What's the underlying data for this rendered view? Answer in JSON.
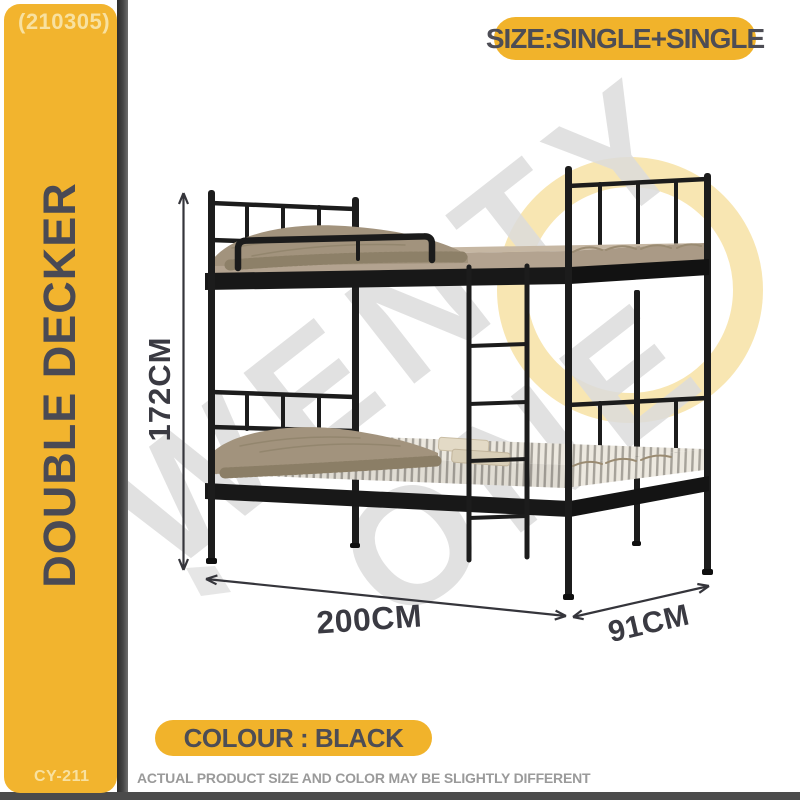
{
  "page": {
    "background": "#ffffff",
    "frame_bar_color": "#4b4b4b"
  },
  "sidebar": {
    "background": "#f2b42e",
    "batch_code": "(210305)",
    "title": "DOUBLE DECKER",
    "model": "CY-211",
    "title_color": "#4a4a54",
    "code_color": "#f8e1a0"
  },
  "badges": {
    "size": {
      "label": "SIZE:SINGLE+SINGLE",
      "background": "#f1b32b",
      "text_color": "#4d4d55"
    },
    "colour": {
      "label": "COLOUR : BLACK",
      "background": "#f1b32b",
      "text_color": "#4d4d55"
    }
  },
  "dimensions": {
    "height_label": "172CM",
    "length_label": "200CM",
    "depth_label": "91CM",
    "annotation_color": "#35353b"
  },
  "watermark": {
    "line1": "TWENTY",
    "line2": "ONE",
    "text_color": "#dcdcdc",
    "ring_color": "#f8e6b2"
  },
  "footer": {
    "disclaimer": "ACTUAL PRODUCT SIZE AND COLOR MAY BE SLIGHTLY DIFFERENT",
    "text_color": "#9a9a9a"
  },
  "illustration": {
    "metal_color": "#1c1c1c",
    "mattress_color": "#c6b7a3",
    "blanket_color": "#a2937d",
    "lower_mattress_base": "#ece8df",
    "stripe_color": "#a6a29a"
  }
}
